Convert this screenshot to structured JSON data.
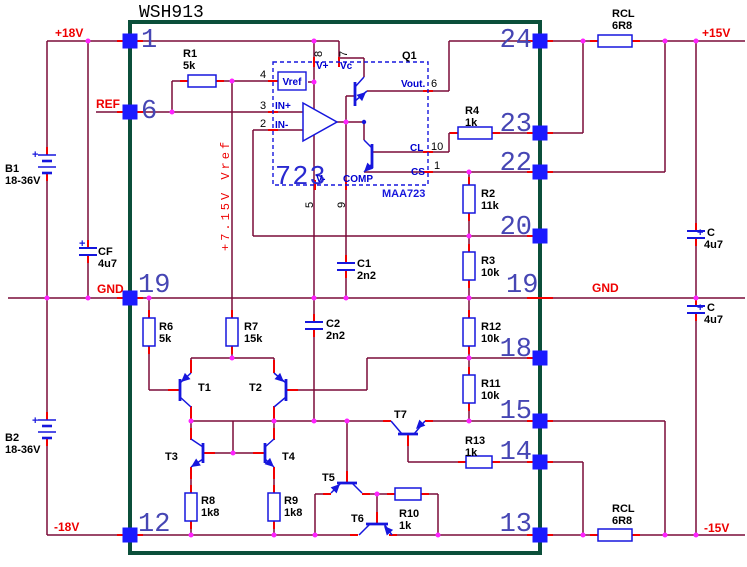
{
  "title": "WSH913",
  "colors": {
    "wire": "#7a0b38",
    "lead": "#f20000",
    "component": "#1616dd",
    "junction": "#ff22ff",
    "module_border": "#0b4f3a",
    "pin_square": "#1a1aff",
    "pin_number": "#4646b4",
    "net_label": "#ee0000",
    "label": "#000000"
  },
  "net_labels": {
    "p18": "+18V",
    "ref": "REF",
    "gnd_left": "GND",
    "gnd_right": "GND",
    "p15": "+15V",
    "m15": "-15V",
    "m18": "-18V",
    "vref_rail": "+7.15V Vref"
  },
  "module_pins": {
    "left": [
      "1",
      "6",
      "19",
      "12"
    ],
    "right": [
      "24",
      "23",
      "22",
      "20",
      "18",
      "15",
      "14",
      "13"
    ],
    "right_inner_19": "19"
  },
  "ic723": {
    "designator": "Q1",
    "label": "723",
    "part": "MAA723",
    "vref_block": "Vref",
    "pin_names": {
      "vplus": "V+",
      "vc": "Vc",
      "vout": "Vout.",
      "cl": "CL",
      "cs": "CS",
      "vminus": "V-",
      "comp": "COMP",
      "in_plus": "IN+",
      "in_minus": "IN-"
    },
    "pin_numbers": {
      "n8": "8",
      "n7": "7",
      "n4": "4",
      "n3": "3",
      "n2": "2",
      "n6": "6",
      "n10": "10",
      "n1": "1",
      "n5": "5",
      "n9": "9"
    }
  },
  "resistors": [
    {
      "name": "R1",
      "value": "5k"
    },
    {
      "name": "R4",
      "value": "1k"
    },
    {
      "name": "R2",
      "value": "11k"
    },
    {
      "name": "R3",
      "value": "10k"
    },
    {
      "name": "R12",
      "value": "10k"
    },
    {
      "name": "R11",
      "value": "10k"
    },
    {
      "name": "R13",
      "value": "1k"
    },
    {
      "name": "R6",
      "value": "5k"
    },
    {
      "name": "R7",
      "value": "15k"
    },
    {
      "name": "R8",
      "value": "1k8"
    },
    {
      "name": "R9",
      "value": "1k8"
    },
    {
      "name": "R10",
      "value": "1k"
    },
    {
      "name": "RCL",
      "value": "6R8"
    },
    {
      "name": "RCL",
      "value": "6R8"
    }
  ],
  "capacitors": [
    {
      "name": "CF",
      "value": "4u7",
      "polarity": "+"
    },
    {
      "name": "C",
      "value": "4u7",
      "polarity": "+"
    },
    {
      "name": "C",
      "value": "4u7",
      "polarity": "+"
    },
    {
      "name": "C1",
      "value": "2n2"
    },
    {
      "name": "C2",
      "value": "2n2"
    }
  ],
  "batteries": [
    {
      "name": "B1",
      "value": "18-36V",
      "polarity": "+"
    },
    {
      "name": "B2",
      "value": "18-36V",
      "polarity": "+"
    }
  ],
  "transistors": [
    "T1",
    "T2",
    "T3",
    "T4",
    "T5",
    "T6",
    "T7"
  ]
}
